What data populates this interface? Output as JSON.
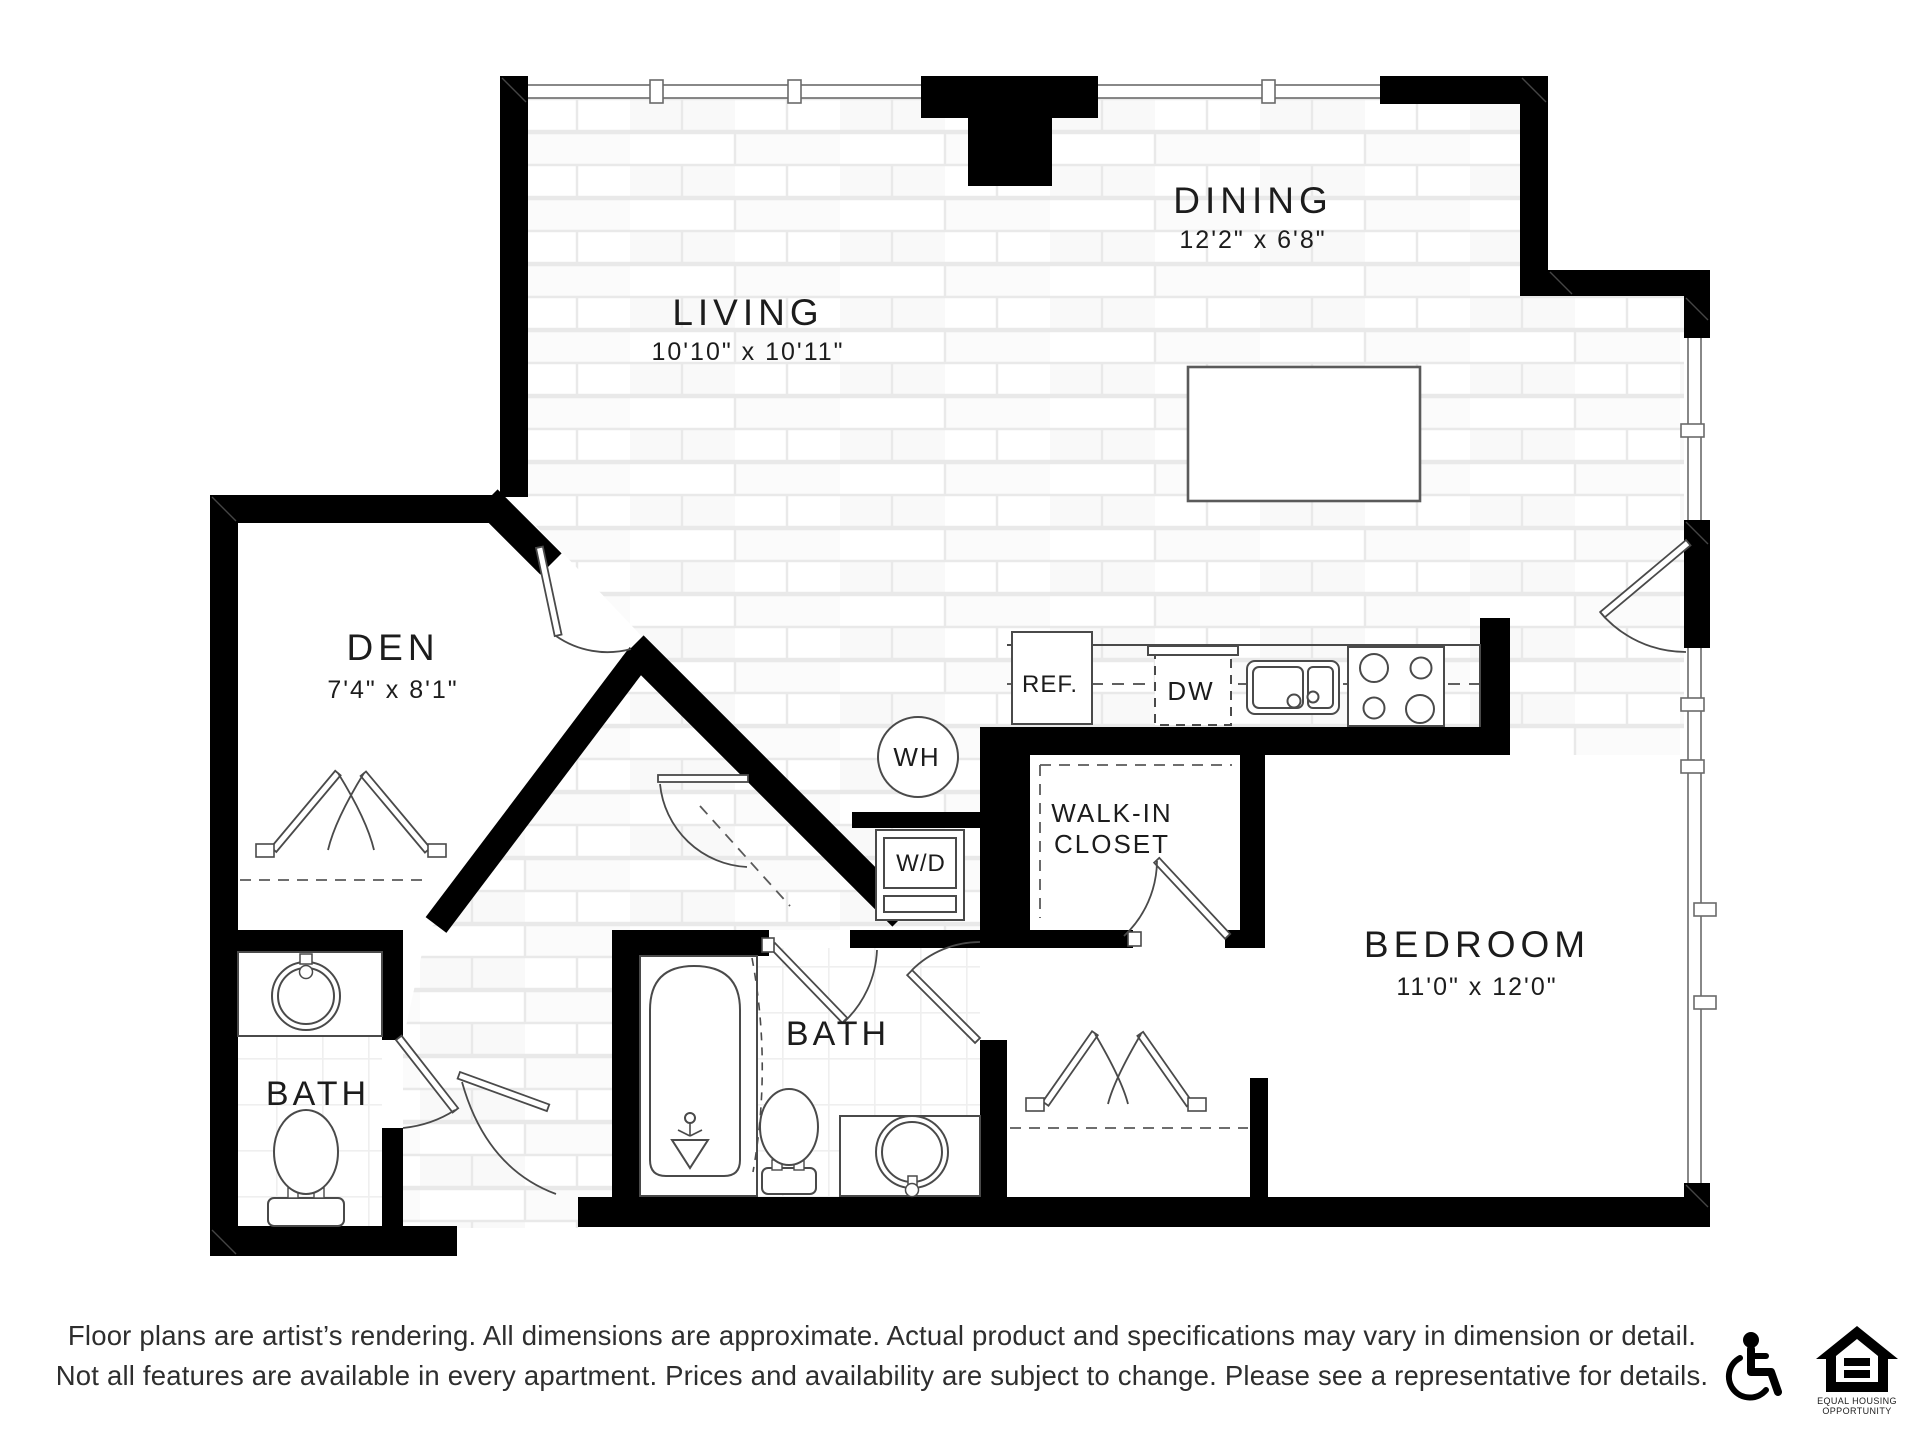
{
  "rooms": {
    "dining": {
      "name": "DINING",
      "dims": "12'2\" x 6'8\""
    },
    "living": {
      "name": "LIVING",
      "dims": "10'10\" x 10'11\""
    },
    "den": {
      "name": "DEN",
      "dims": "7'4\" x 8'1\""
    },
    "bedroom": {
      "name": "BEDROOM",
      "dims": "11'0\" x 12'0\""
    },
    "bath_left": {
      "name": "BATH"
    },
    "bath_center": {
      "name": "BATH"
    },
    "walk_in_closet": {
      "line1": "WALK-IN",
      "line2": "CLOSET"
    }
  },
  "fixtures": {
    "water_heater": "WH",
    "washer_dryer": "W/D",
    "refrigerator": "REF.",
    "dishwasher": "DW"
  },
  "disclaimer": {
    "line1": "Floor plans are artist’s rendering. All dimensions are approximate. Actual product and specifications may vary in dimension or detail.",
    "line2": "Not all features are available in every apartment. Prices and availability are subject to change. Please see a representative for details."
  },
  "logos": {
    "eho_line1": "EQUAL HOUSING",
    "eho_line2": "OPPORTUNITY"
  },
  "colors": {
    "wall": "#000000",
    "fixture_line": "#4a4a4a",
    "thin_line": "#6a6a6a",
    "brick_line": "#e9e9e9",
    "text": "#1c1c1c"
  }
}
